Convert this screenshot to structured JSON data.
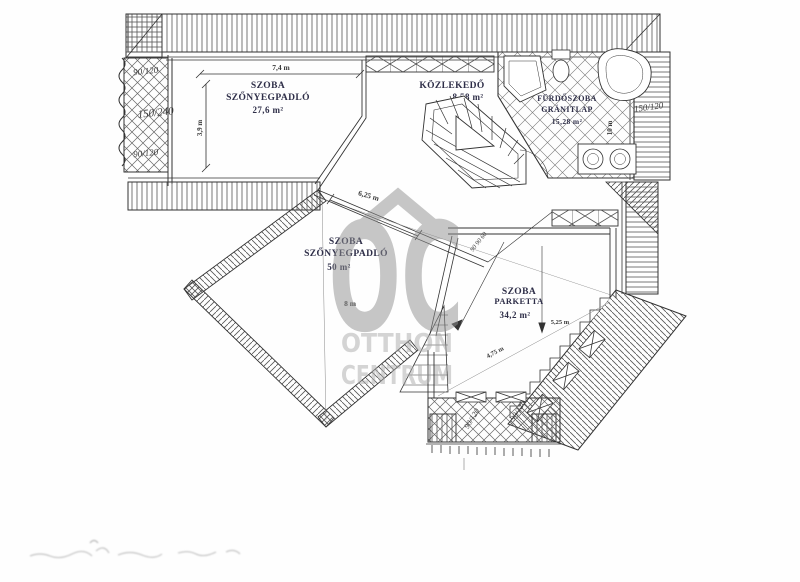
{
  "rooms": [
    {
      "name1": "SZOBA",
      "name2": "SZŐNYEGPADLÓ",
      "area": "27,6 m²"
    },
    {
      "name1": "KÖZLEKEDŐ",
      "area": "8,58 m²"
    },
    {
      "name1": "FÜRDŐSZOBA",
      "name2": "GRÁNITLAP",
      "area": "15,28 m²"
    },
    {
      "name1": "SZOBA",
      "name2": "SZŐNYEGPADLÓ",
      "area": "50 m²"
    },
    {
      "name1": "SZOBA",
      "name2": "PARKETTA",
      "area": "34,2 m²"
    }
  ],
  "dimensions": {
    "room1_width": "7,4 m",
    "room1_depth": "3,9 m",
    "room4_width": "6,25 m",
    "room4_diagonal": "8 m",
    "room5_width": "5,25 m",
    "room5_depth": "4,75 m",
    "bath_side": "10 m"
  },
  "window_sizes": {
    "left_top": "90/120",
    "left_middle": "150/240",
    "left_bottom": "90/120",
    "right": "150/120",
    "balcony_left": "90/120",
    "balcony_right": "90/120",
    "wall_note": "90 90 60"
  },
  "watermark": {
    "logo": "OC",
    "line1": "OTTHON",
    "line2": "CENTRUM"
  },
  "colors": {
    "line": "#333333",
    "hatch": "#555555",
    "watermark": "#8f8f8f"
  }
}
